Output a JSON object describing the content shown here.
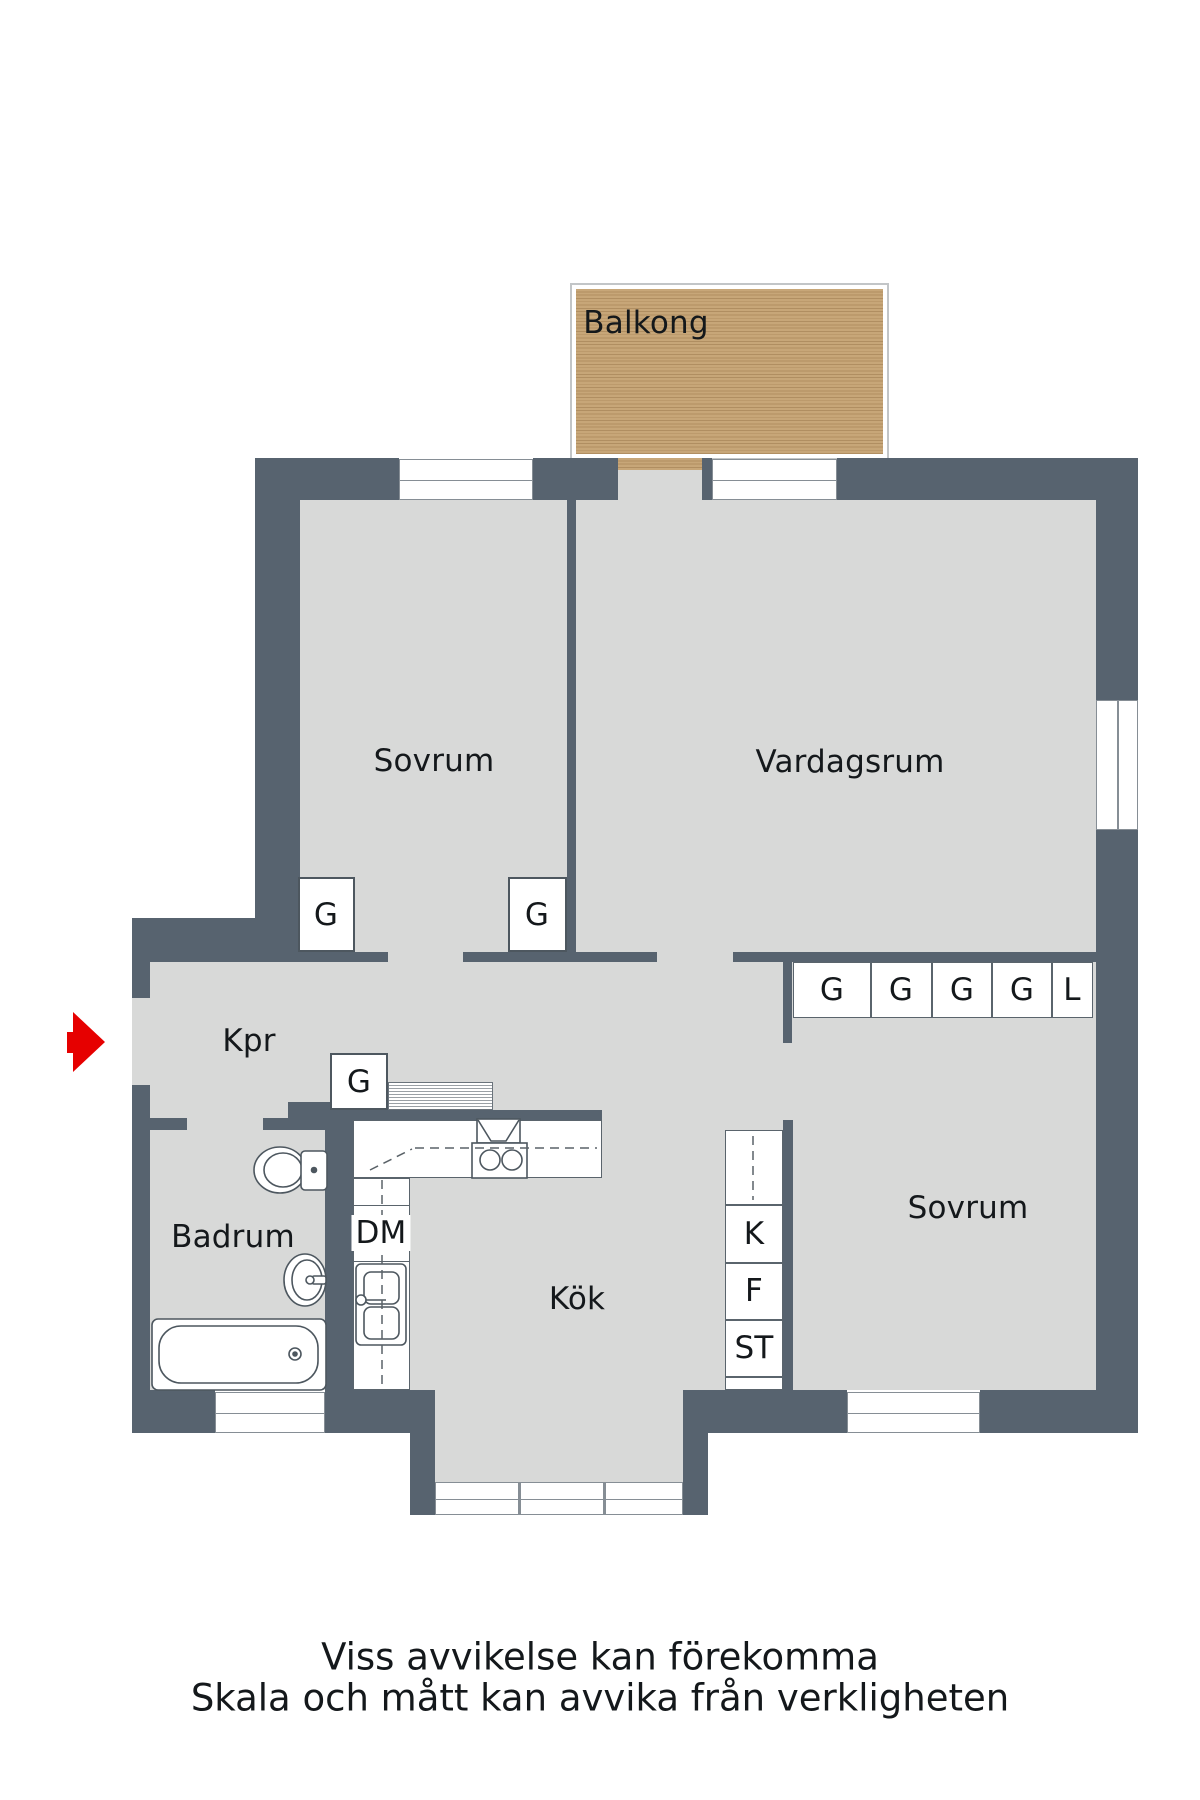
{
  "colors": {
    "wall": "#57636F",
    "floor": "#d8d9d8",
    "wood": "#c7a678",
    "wood_stripe": "#b08e61",
    "arrow": "#e60000",
    "ink": "#14181b"
  },
  "balcony": {
    "label": "Balkong"
  },
  "rooms": {
    "bedroom_top": {
      "label": "Sovrum"
    },
    "living_room": {
      "label": "Vardagsrum"
    },
    "hallway": {
      "label": "Kpr"
    },
    "bathroom": {
      "label": "Badrum"
    },
    "kitchen": {
      "label": "Kök"
    },
    "bedroom_bottom": {
      "label": "Sovrum"
    }
  },
  "storage": {
    "bedroom_top_closet_left": "G",
    "bedroom_top_closet_right": "G",
    "hallway_closet": "G",
    "wardrobe_row": [
      "G",
      "G",
      "G",
      "G",
      "L"
    ],
    "dishwasher": "DM",
    "tall_units": [
      "K",
      "F",
      "ST"
    ]
  },
  "footer": {
    "line1": "Viss avvikelse kan förekomma",
    "line2": "Skala och mått kan avvika från verkligheten"
  }
}
